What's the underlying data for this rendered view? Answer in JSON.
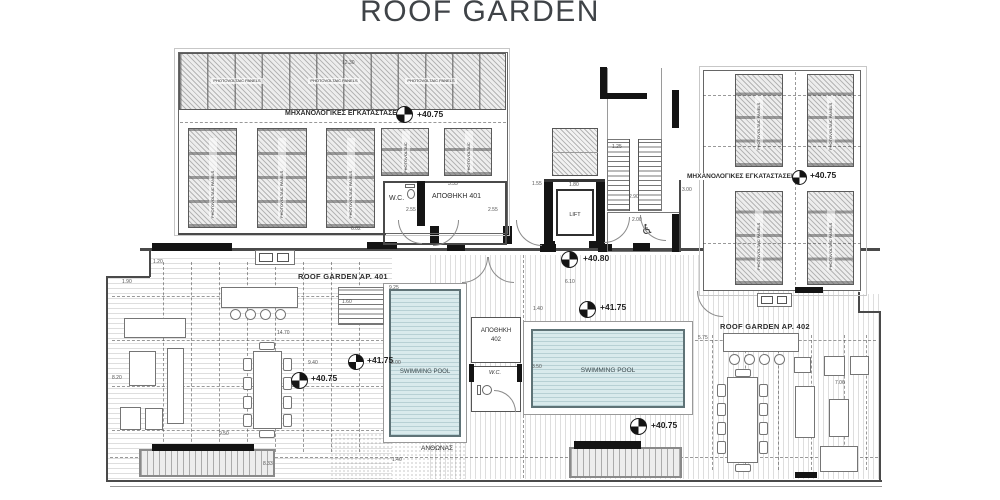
{
  "title": "ROOF GARDEN",
  "areas": {
    "mech_label": "ΜΗΧΑΝΟΛΟΓΙΚΕΣ ΕΓΚΑΤΑΣΤΑΣΕΙΣ",
    "pv_panel_label": "PHOTOVOLTAIC PANELS",
    "roof_garden_401": "ROOF GARDEN  AP. 401",
    "roof_garden_402": "ROOF GARDEN  AP. 402",
    "pool_label": "SWIMMING POOL",
    "flowerbed_label": "ΑΝΘΩΝΑΣ"
  },
  "rooms": {
    "wc_401": "W.C.",
    "storage_401": "ΑΠΟΘΗΚΗ 401",
    "lift": "LIFT",
    "storage_402_l1": "ΑΠΟΘΗΚΗ",
    "storage_402_l2": "402",
    "wc_402": "W.C."
  },
  "elevations": {
    "mech_left": "+40.75",
    "mech_right": "+40.75",
    "entry": "+40.80",
    "deck_401": "+40.75",
    "pool_401": "+41.75",
    "pool_mid": "+41.75",
    "deck_402": "+40.75"
  },
  "dims": {
    "d1": "12.30",
    "d2": "1.20",
    "d3": "6.02",
    "d4": "3.33",
    "d5": "2.55",
    "d6": "2.55",
    "d7": "1.55",
    "d8": "1.80",
    "d9": "1.25",
    "d10": "2.90",
    "d11": "2.00",
    "d12": "3.00",
    "d13": "6.10",
    "d14": "1.90",
    "d15": "14.70",
    "d16": "9.40",
    "d17": "8.20",
    "d18": "9.50",
    "d19": "8.33",
    "d20": "1.60",
    "d21": "9.25",
    "d22": "8.00",
    "d23": "3.50",
    "d24": "1.40",
    "d25": "5.75",
    "d26": "7.06",
    "d27": "1.40"
  },
  "colors": {
    "pool_water": "#d9eaec",
    "wall_poche": "#141414",
    "line": "#4a4a4a"
  }
}
